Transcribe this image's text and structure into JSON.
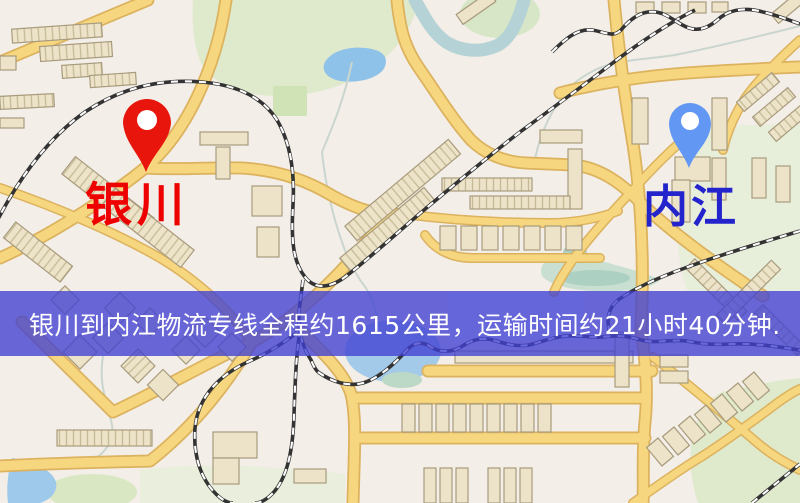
{
  "banner": {
    "text": "银川到内江物流专线全程约1615公里，运输时间约21小时40分钟.",
    "background_color": "#4040d2",
    "text_color": "#ffffff"
  },
  "markers": {
    "origin": {
      "label": "银川",
      "pin_color": "#e8150c",
      "pin_hole_color": "#ffffff",
      "label_color": "#ee0000"
    },
    "destination": {
      "label": "内江",
      "pin_color": "#6297f3",
      "pin_hole_color": "#ffffff",
      "label_color": "#2424cd"
    }
  },
  "map_colors": {
    "background": "#f3eee7",
    "road_fill": "#f6d77f",
    "road_casing": "#dcb25e",
    "building": "#ece3c9",
    "building_outline": "#a89b7d",
    "park_green": "#dfe9cc",
    "water_blue": "#9ec9ea",
    "railway": "#333333"
  }
}
